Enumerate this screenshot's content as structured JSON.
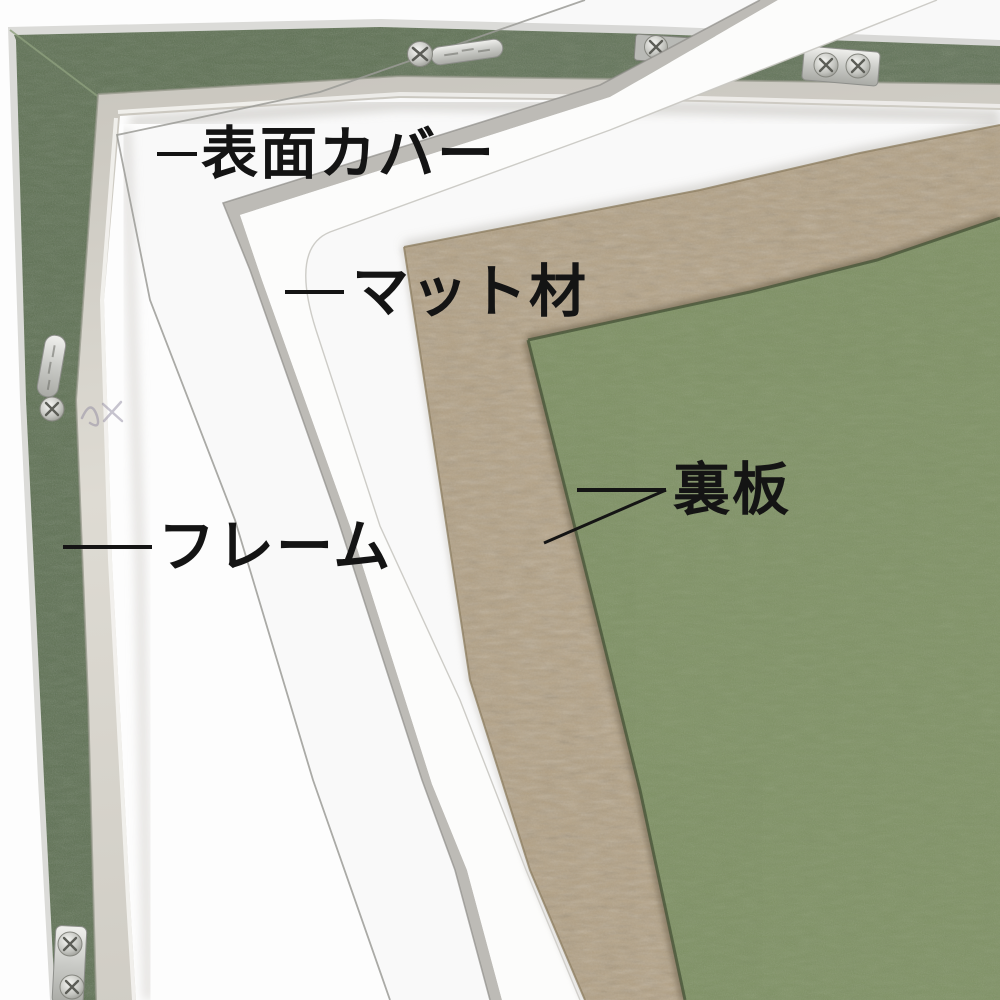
{
  "labels": {
    "surface_cover": {
      "text": "表面カバー"
    },
    "mat": {
      "text": "マット材"
    },
    "frame": {
      "text": "フレーム"
    },
    "back_board": {
      "text": "裏板"
    }
  },
  "parts": [
    {
      "name": "surface-cover",
      "label": "表面カバー",
      "appearance": "clear transparent sheet, thin grey edge lines"
    },
    {
      "name": "mat",
      "label": "マット材",
      "appearance": "white mat board seen edge-on as bright band with grey shadow"
    },
    {
      "name": "frame",
      "label": "フレーム",
      "appearance": "aluminum frame, green felt back, silver inner lip"
    },
    {
      "name": "back-board",
      "label": "裏板",
      "appearance": "brown MDF board with green face board"
    }
  ],
  "hardware": {
    "screw_icon": "phillips-screw",
    "corner_plate_icon": "metal-corner-plate",
    "hanger_plate_icon": "stamped-hanger-plate",
    "screw_count": 7,
    "plate_count": 5
  },
  "colors": {
    "backdrop": "#fdfdfd",
    "frame_green": "#5d7052",
    "frame_rim": "#dbdbd8",
    "frame_lip": "#d6d3cb",
    "mat_white": "#fcfcfb",
    "mat_shadow": "#bdbbb6",
    "mdf_tan": "#b3a184",
    "board_green": "#7e9163",
    "board_seam": "#48563a",
    "metal": "#d2d3d0",
    "cover_edge": "#9b9b97",
    "label_ink": "#141414"
  }
}
